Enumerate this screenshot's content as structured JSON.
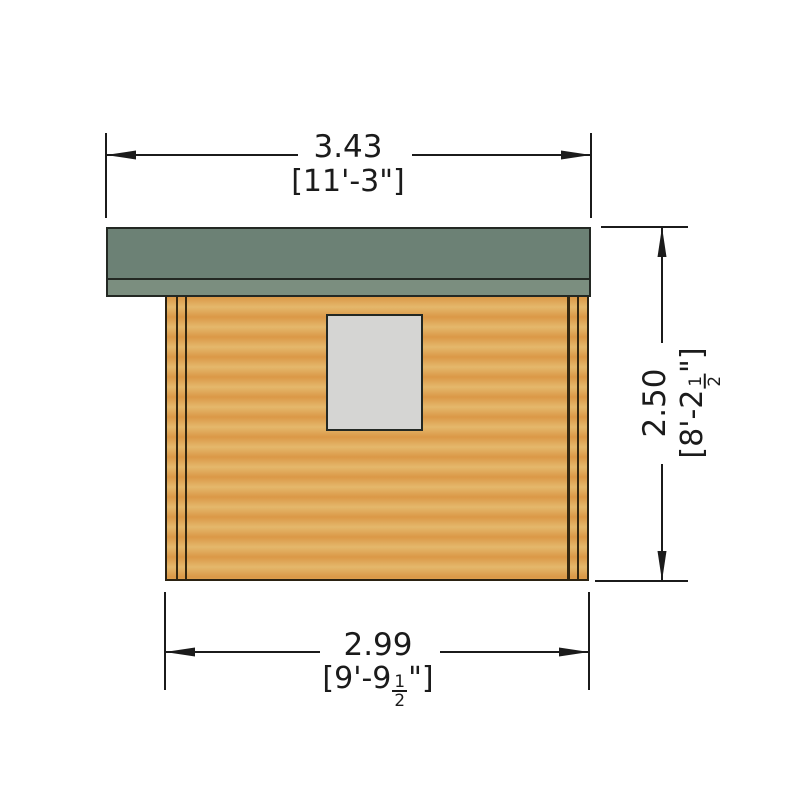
{
  "colors": {
    "page_bg": "#ffffff",
    "ink": "#1b1b1b",
    "outline": "#232823",
    "roof_green": "#6c8175",
    "roof_fascia": "#7b8e7f",
    "wood_dark": "#db9847",
    "wood_light": "#e4b86c",
    "trim_line": "#35270f",
    "wall_outline": "#2b2212",
    "window_fill": "#d5d5d3"
  },
  "dimensions": {
    "overall_width": {
      "metric": "3.43",
      "imperial": "[11'-3\"]"
    },
    "overall_height": {
      "metric": "2.50",
      "imperial_pre": "[8'-2",
      "frac_num": "1",
      "frac_den": "2",
      "imperial_post": "\"]"
    },
    "base_width": {
      "metric": "2.99",
      "imperial_pre": "[9'-9",
      "frac_num": "1",
      "frac_den": "2",
      "imperial_post": "\"]"
    }
  }
}
